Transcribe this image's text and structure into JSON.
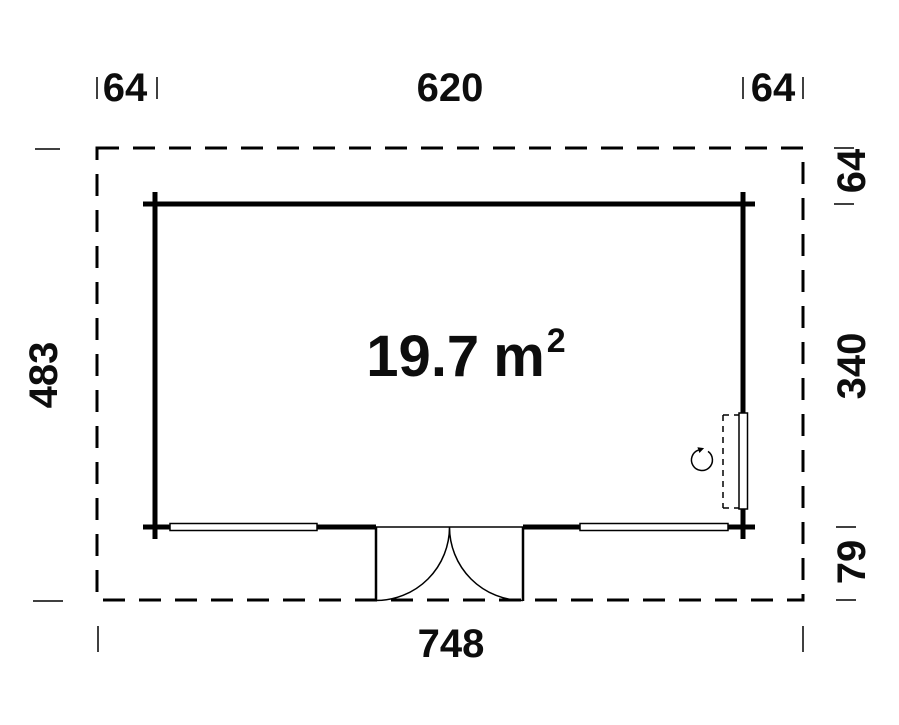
{
  "page": {
    "background": "#ffffff",
    "line_color": "#000000",
    "text_color": "#0d0d0d",
    "drawing_type": "garden-house-floor-plan"
  },
  "area_label": {
    "value": "19.7",
    "unit": "m",
    "superscript": "2"
  },
  "dimensions": {
    "top_left_overhang": "64",
    "top_width": "620",
    "top_right_overhang": "64",
    "left_total_depth": "483",
    "right_top_overhang": "64",
    "right_inner_depth": "340",
    "right_porch_depth": "79",
    "bottom_total_width": "748"
  }
}
